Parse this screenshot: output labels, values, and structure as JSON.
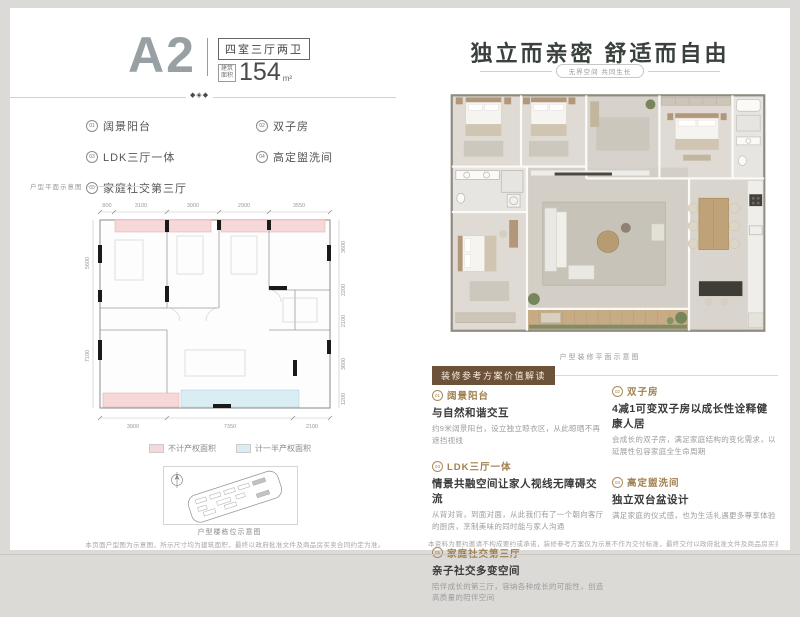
{
  "header": {
    "unit": "A2",
    "layout": "四室三厅两卫",
    "area_label_top": "建筑",
    "area_label_bottom": "面积",
    "area_value": "154",
    "area_unit": "m²"
  },
  "ornament_glyph": "◆◈◆",
  "features": [
    {
      "num": "01",
      "label": "阔景阳台"
    },
    {
      "num": "02",
      "label": "双子房"
    },
    {
      "num": "03",
      "label": "LDK三厅一体"
    },
    {
      "num": "04",
      "label": "高定盥洗间"
    },
    {
      "num": "05",
      "label": "家庭社交第三厅"
    }
  ],
  "floorplan": {
    "caption": "户型平面示意图",
    "dims_top": [
      "800",
      "3100",
      "3000",
      "2900",
      "3550"
    ],
    "dims_bottom": [
      "3900",
      "7350",
      "2100"
    ],
    "dims_left": [
      "5600",
      "7100"
    ],
    "dims_right": [
      "3600",
      "2200",
      "2100",
      "3600",
      "1200"
    ],
    "legend": [
      {
        "label": "不计产权面积",
        "color": "#f7d8d9"
      },
      {
        "label": "计一半产权面积",
        "color": "#daedf3"
      }
    ]
  },
  "siteplan": {
    "caption": "户型楼栋位示意图"
  },
  "right_panel": {
    "headline": "独立而亲密  舒适而自由",
    "subtitle": "无界空间 共同生长",
    "render_caption": "户型装修平面示意图",
    "badge": "装修参考方案价值解读",
    "values_left": [
      {
        "num": "01",
        "title": "阔景阳台",
        "subtitle": "与自然和谐交互",
        "body": "约9米阔景阳台，设立独立晾衣区，从此晾晒不再遮挡视线"
      },
      {
        "num": "03",
        "title": "LDK三厅一体",
        "subtitle": "情景共融空间让家人视线无障碍交流",
        "body": "从背对背，到面对面，从此我们有了一个朝向客厅的厨房，烹制美味的同时能与家人沟通"
      },
      {
        "num": "05",
        "title": "家庭社交第三厅",
        "subtitle": "亲子社交多变空间",
        "body": "陪伴成长的第三厅，容纳各种成长的可能性，创造高质量的陪伴空间"
      }
    ],
    "values_right": [
      {
        "num": "02",
        "title": "双子房",
        "subtitle": "4减1可变双子房以成长性诠释健康人居",
        "body": "会成长的双子房，满足家庭结构的变化需求，以延展性包容家庭全生命周期"
      },
      {
        "num": "04",
        "title": "高定盥洗间",
        "subtitle": "独立双台盆设计",
        "body": "满足家庭的仪式感，也为生活礼遇更多尊享体验"
      }
    ]
  },
  "disclaimers": {
    "left": "本页面户型图为示意图，所示尺寸均为建筑面积，最终以政府批准文件及商品房买卖合同约定为准。",
    "right": "本资料为要约邀请不构成要约或承诺，装修参考方案仅为示意不作为交付标准，最终交付以政府批准文件及商品房买卖合同为准。"
  }
}
